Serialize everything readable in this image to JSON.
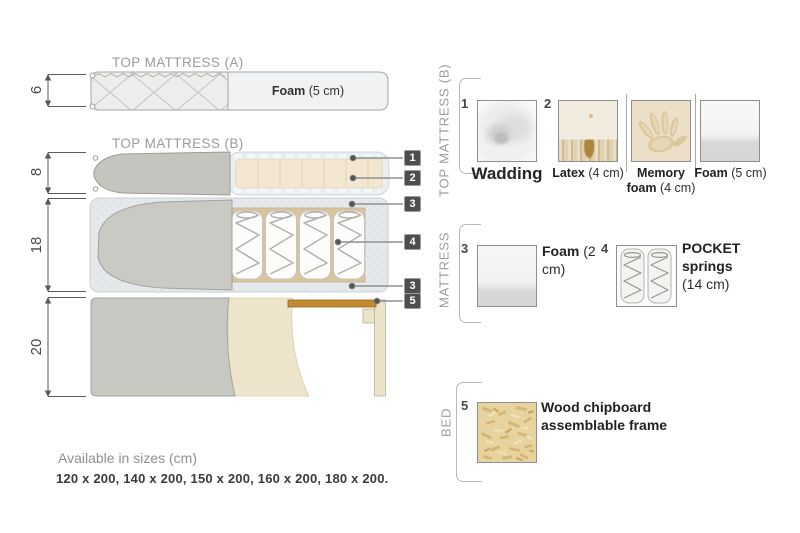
{
  "diagram": {
    "titles": {
      "a": "TOP MATTRESS (A)",
      "b": "TOP MATTRESS (B)"
    },
    "dimensions": {
      "a": "6",
      "b": "8",
      "mattress": "18",
      "bed": "20"
    },
    "foam_layer": {
      "name": "Foam",
      "size": "(5 cm)"
    },
    "badges": [
      "1",
      "2",
      "3",
      "4",
      "3",
      "5"
    ]
  },
  "legend": {
    "sections": [
      {
        "label": "TOP MATTRESS (B)",
        "items": [
          {
            "number": "1",
            "name": "Wadding",
            "detail": "",
            "image": "wadding-photo"
          },
          {
            "number": "2",
            "name": "Latex",
            "detail": "(4 cm)",
            "image": "latex-photo"
          },
          {
            "number": "",
            "name": "Memory foam",
            "detail": "(4 cm)",
            "image": "memory-foam-photo"
          },
          {
            "number": "",
            "name": "Foam",
            "detail": "(5 cm)",
            "image": "foam-photo"
          }
        ]
      },
      {
        "label": "MATTRESS",
        "items": [
          {
            "number": "3",
            "name": "Foam",
            "detail": "(2 cm)",
            "image": "foam-photo"
          },
          {
            "number": "4",
            "name": "POCKET springs",
            "detail": "(14 cm)",
            "image": "pocket-springs-photo"
          }
        ]
      },
      {
        "label": "BED",
        "items": [
          {
            "number": "5",
            "name": "Wood chipboard assemblable frame",
            "detail": "",
            "image": "chipboard-photo"
          }
        ]
      }
    ]
  },
  "footer": {
    "availability": "Available in sizes (cm)",
    "sizes": "120 x 200, 140 x 200, 150 x 200, 160 x 200, 180 x 200."
  },
  "colors": {
    "wood": "#c08a2e",
    "fabric_gray": "#c6c6c0",
    "foam_tan": "#f4e7d1",
    "wadding_blue": "#e9edf0",
    "badge_gray": "#4e4e4e"
  }
}
